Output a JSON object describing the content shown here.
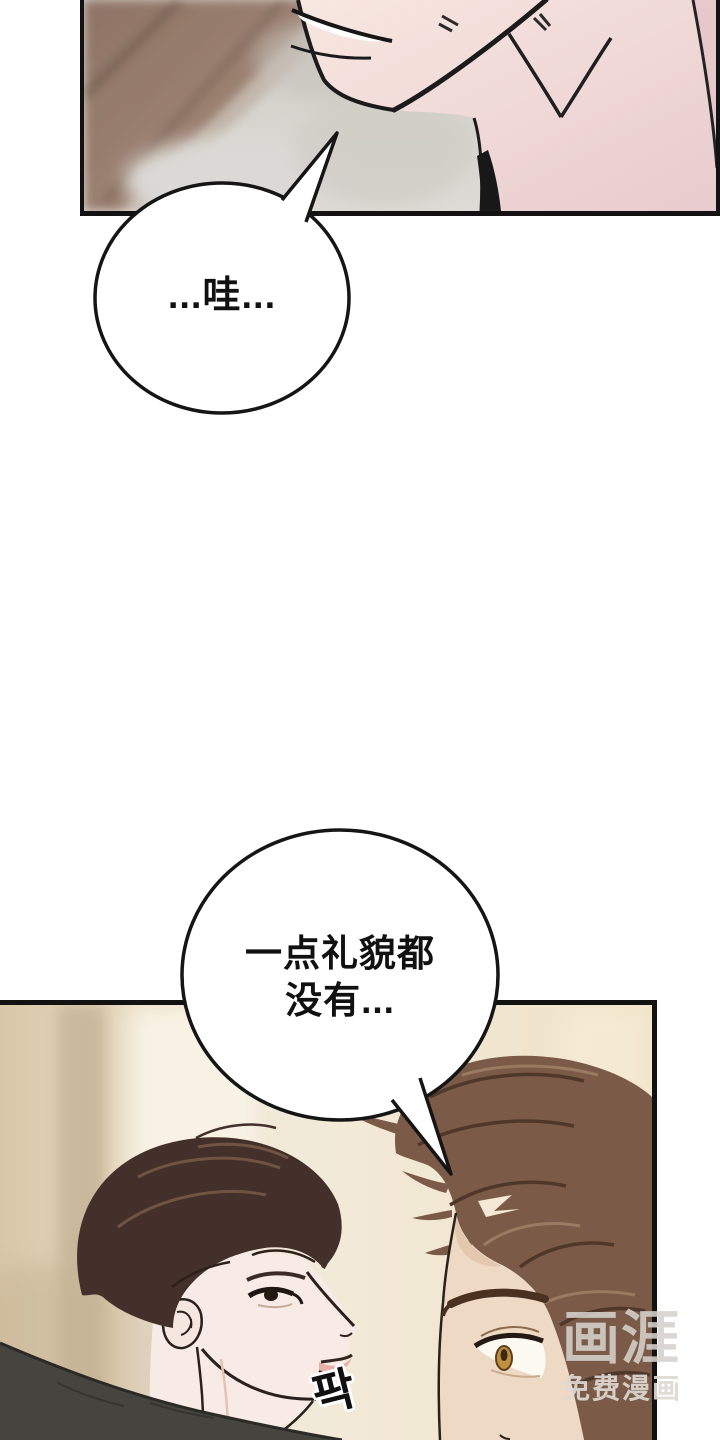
{
  "page": {
    "type": "webtoon-comic-page",
    "language": "zh-CN",
    "background_color": "#ffffff"
  },
  "panels": [
    {
      "id": "panel-top",
      "alt": "close-up of a man's chin, smiling mouth and bare neck; blurred wooden floor behind",
      "border_color": "#121212"
    },
    {
      "id": "panel-bottom",
      "alt": "dark-haired man in profile smirking face-to-face at a brown-haired man in a beige room",
      "border_color": "#121212"
    }
  ],
  "speech_bubbles": [
    {
      "id": "bubble-1",
      "text": "...哇..."
    },
    {
      "id": "bubble-2",
      "line1": "一点礼貌都",
      "line2": "没有..."
    }
  ],
  "sfx": {
    "text": "팍"
  },
  "watermark": {
    "logo": "画涯",
    "tagline": "免费漫画"
  },
  "colors": {
    "outline": "#1b1b1b",
    "panel_border": "#121212",
    "bubble_fill": "#ffffff",
    "skin_light": "#f8e7e0",
    "skin_rosy": "#e8cbce",
    "wood_brown": "#8f7466",
    "blur_gray": "#d5d2cd",
    "wall_beige": "#d9c7a9",
    "wall_light": "#f2ead9",
    "hair_dark_brown": "#43302a",
    "hair_warm_brown": "#7b5b47",
    "shirt_charcoal": "#45443f",
    "iris_amber": "#c0903f",
    "lip_pink": "#e5aba1",
    "watermark_gray": "#d5d2cc"
  }
}
